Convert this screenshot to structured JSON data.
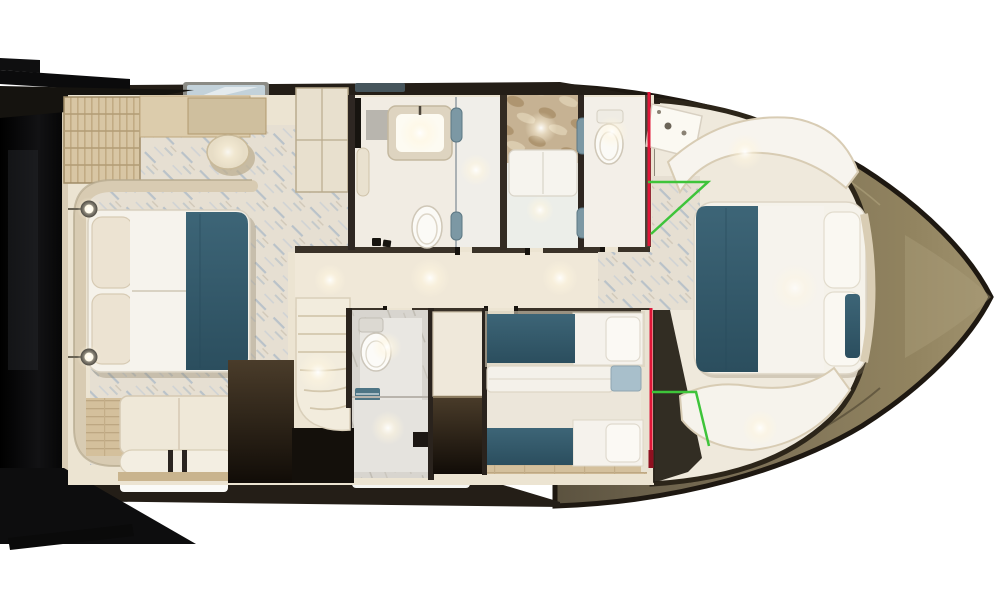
{
  "scene": {
    "kind": "yacht-lower-deck-floorplan-render",
    "orientation": "bow-pointing-right",
    "background": "#ffffff"
  },
  "colors": {
    "hull-dark": "#1e1811",
    "hull-olive-1": "#5c5340",
    "hull-olive-2": "#7d7157",
    "hull-olive-3": "#a1936f",
    "black": "#0a0a0b",
    "cream": "#ece4d2",
    "cream-dark": "#cfc3aa",
    "liner": "#efe9dc",
    "wood": "#d8c6a4",
    "wood-dark": "#c2ab84",
    "marble-base": "#e6dfd2",
    "marble-vein": "#93a9c0",
    "teal": "#34596a",
    "teal-light": "#7c98a4",
    "tray-blue": "#a8bfcb",
    "glass-blue": "#c3d2da",
    "white-soft": "#f5f2ea",
    "floor-light": "#f0ebe1",
    "grey-stone": "#d8d5cf",
    "annotation-red": "#e01638",
    "annotation-red-dark": "#8f1020",
    "annotation-green": "#3ec43a"
  },
  "rooms": [
    {
      "id": "aft-garage",
      "features": [
        "black-deck-hatch",
        "swim-platform-steps"
      ]
    },
    {
      "id": "master-cabin",
      "features": [
        "double-bed-teal-runner",
        "reading-lamps",
        "vanity-stool",
        "wood-stairs",
        "settee",
        "marble-floor"
      ]
    },
    {
      "id": "companionway",
      "features": [
        "corridor",
        "curved-stairs",
        "dark-stair-housing"
      ]
    },
    {
      "id": "bathroom-forward-port",
      "features": [
        "lit-vanity",
        "toilet",
        "shower-glass-teal-handles"
      ]
    },
    {
      "id": "shower-room-center",
      "features": [
        "stone-wall",
        "bench"
      ]
    },
    {
      "id": "bathroom-forward-starboard",
      "features": [
        "toilet",
        "angled-sink-counter"
      ]
    },
    {
      "id": "day-head",
      "features": [
        "toilet",
        "teal-towels",
        "shower"
      ]
    },
    {
      "id": "wardrobe",
      "features": [
        "dark-lockers"
      ]
    },
    {
      "id": "twin-cabin",
      "features": [
        "two-single-beds-teal",
        "center-console",
        "blue-tray",
        "wood-floor"
      ]
    },
    {
      "id": "vip-forward-cabin",
      "features": [
        "double-bed-teal-runner",
        "bow-settees",
        "marble-entry",
        "curved-headboard"
      ]
    }
  ],
  "annotations": {
    "red_lines": [
      {
        "points": "649,92 649,246",
        "width": 3,
        "shade": "annotation-red"
      },
      {
        "points": "651,308 651,452",
        "width": 3,
        "shade": "annotation-red"
      },
      {
        "points": "651,450 651,468",
        "width": 5,
        "shade": "annotation-red-dark"
      }
    ],
    "green_lines": [
      {
        "points": "648,182 708,182 651,234",
        "width": 2.5,
        "shade": "annotation-green"
      },
      {
        "points": "652,392 696,392 709,446",
        "width": 2.5,
        "shade": "annotation-green"
      }
    ]
  }
}
